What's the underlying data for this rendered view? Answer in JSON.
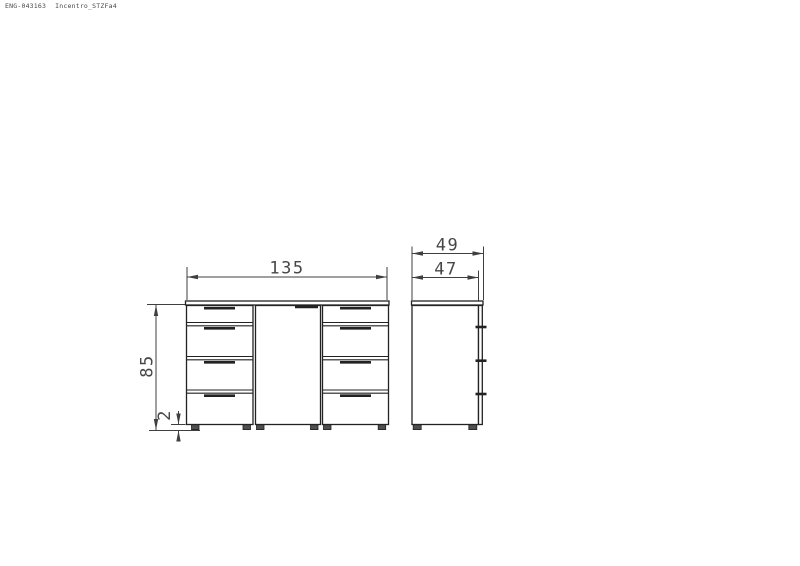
{
  "header": {
    "doc_code": "ENG-043163",
    "model_name": "Incentro_STZFa4"
  },
  "front_view": {
    "width_label": "135",
    "height_label": "85",
    "plinth_height_label": "2"
  },
  "side_view": {
    "overall_depth_label": "49",
    "body_depth_label": "47"
  },
  "colors": {
    "background": "#ffffff",
    "object_line": "#222222",
    "dimension_line": "#3f3f3f",
    "dimension_text": "#474747",
    "feet_fill": "#4f4f4f"
  }
}
